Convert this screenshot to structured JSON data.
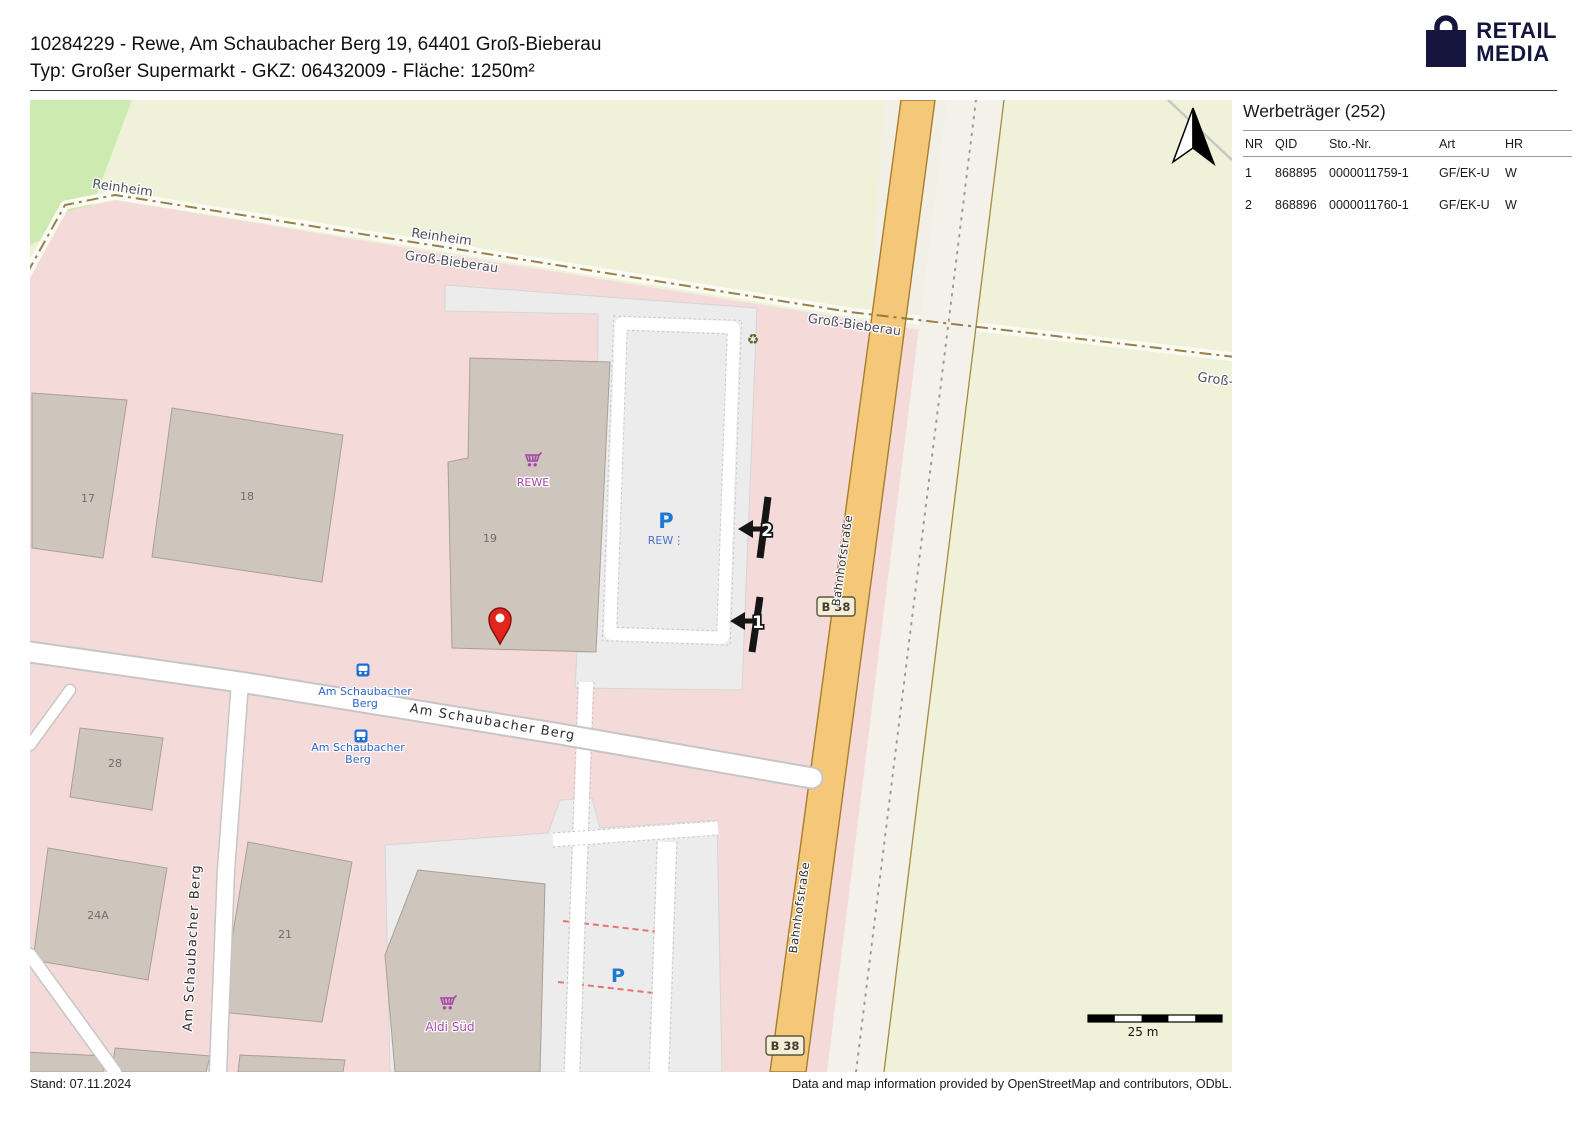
{
  "header": {
    "line1": "10284229 - Rewe, Am Schaubacher Berg 19, 64401 Groß-Bieberau",
    "line2": "Typ: Großer Supermarkt - GKZ: 06432009 - Fläche: 1250m²"
  },
  "logo": {
    "line1": "RETAIL",
    "line2": "MEDIA",
    "color": "#15153e"
  },
  "panel": {
    "title": "Werbeträger (252)",
    "columns": [
      "NR",
      "QID",
      "Sto.-Nr.",
      "Art",
      "HR"
    ],
    "rows": [
      [
        "1",
        "868895",
        "0000011759-1",
        "GF/EK-U",
        "W"
      ],
      [
        "2",
        "868896",
        "0000011760-1",
        "GF/EK-U",
        "W"
      ]
    ]
  },
  "footer": {
    "left": "Stand: 07.11.2024",
    "right": "Data and map information provided by OpenStreetMap and contributors, ODbL."
  },
  "map": {
    "labels": {
      "reinheim": "Reinheim",
      "gross_bieberau": "Groß-Bieberau",
      "bahnhofstrasse": "Bahnhofstraße",
      "am_schaubacher_berg": "Am Schaubacher Berg",
      "bus_stop_line1": "Am Schaubacher",
      "bus_stop_line2": "Berg",
      "rewe": "REWE",
      "aldi": "Aldi Süd",
      "parking_p": "P",
      "parking_rewe": "REW⋮",
      "b38": "B 38",
      "scale": "25 m"
    },
    "numbers": {
      "b17": "17",
      "b18": "18",
      "b19": "19",
      "b28": "28",
      "b24a": "24A",
      "b21": "21"
    },
    "icons": {
      "recycling": "♻"
    },
    "markers": {
      "m1": "1",
      "m2": "2"
    },
    "colors": {
      "farmland": "#eff1d8",
      "grass": "#cdebb0",
      "residential": "#f4dbd9",
      "building": "#cec5bc",
      "parking": "#ececec",
      "road_primary": "#f5c778",
      "pin_red": "#e1261d",
      "poi_purple": "#a845a8",
      "parking_blue": "#1e79d4",
      "bus_blue": "#1d6ed2",
      "boundary": "#8d7233"
    }
  }
}
